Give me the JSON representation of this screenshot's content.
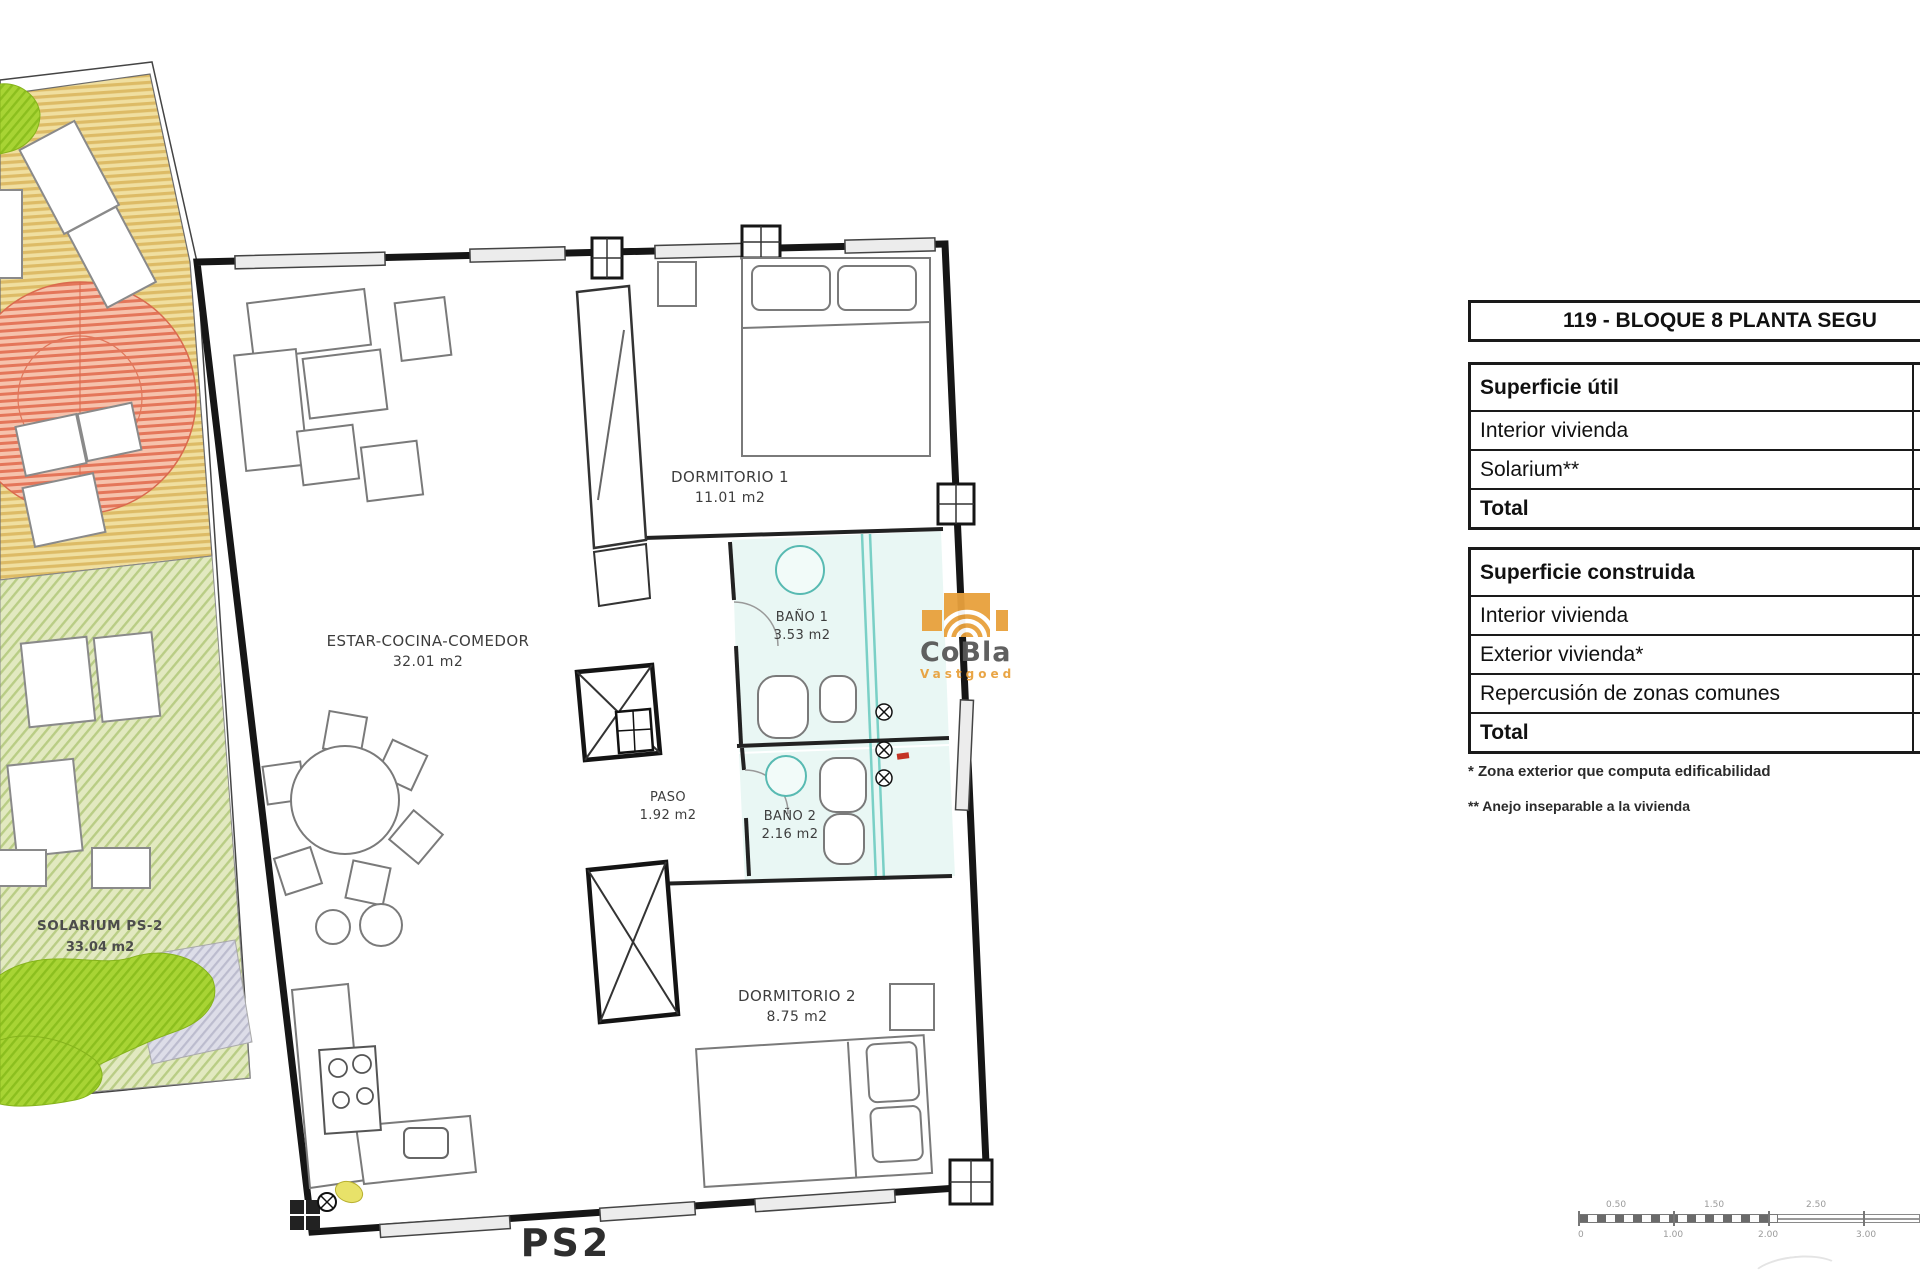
{
  "watermark": {
    "brand": "CoBla",
    "subtitle": "Vastgoed",
    "accent_color": "#E8A13C"
  },
  "floor_plan": {
    "plan_label": "PS2",
    "rooms": [
      {
        "name": "ESTAR-COCINA-COMEDOR",
        "area": "32.01 m2"
      },
      {
        "name": "DORMITORIO 1",
        "area": "11.01 m2"
      },
      {
        "name": "BAÑO 1",
        "area": "3.53 m2"
      },
      {
        "name": "PASO",
        "area": "1.92 m2"
      },
      {
        "name": "BAÑO 2",
        "area": "2.16 m2"
      },
      {
        "name": "DORMITORIO 2",
        "area": "8.75 m2"
      },
      {
        "name": "SOLARIUM PS-2",
        "area": "33.04 m2"
      }
    ],
    "colors": {
      "deck": "#f0dfa0",
      "deck_stripe": "#ddbb66",
      "pergola": "#f6c2ac",
      "pergola_stripe": "#e4765a",
      "lawn": "#e2e9c0",
      "lawn_stripe": "#b9cd85",
      "bush": "#a8d434",
      "bath_tint": "#e9f7f4",
      "glass": "#7ad0c6"
    }
  },
  "info_panel": {
    "title": "119 - BLOQUE 8 PLANTA SEGU",
    "tables": [
      {
        "header": "Superficie útil",
        "rows": [
          "Interior vivienda",
          "Solarium**",
          "Total"
        ]
      },
      {
        "header": "Superficie construida",
        "rows": [
          "Interior vivienda",
          "Exterior vivienda*",
          "Repercusión de zonas comunes",
          "Total"
        ]
      }
    ],
    "footnotes": [
      "* Zona exterior que computa edificabilidad",
      "** Anejo inseparable a la vivienda"
    ]
  },
  "scale_bar": {
    "upper_labels": [
      "0.50",
      "1.50",
      "2.50"
    ],
    "lower_labels": [
      "0",
      "1.00",
      "2.00",
      "3.00"
    ]
  }
}
